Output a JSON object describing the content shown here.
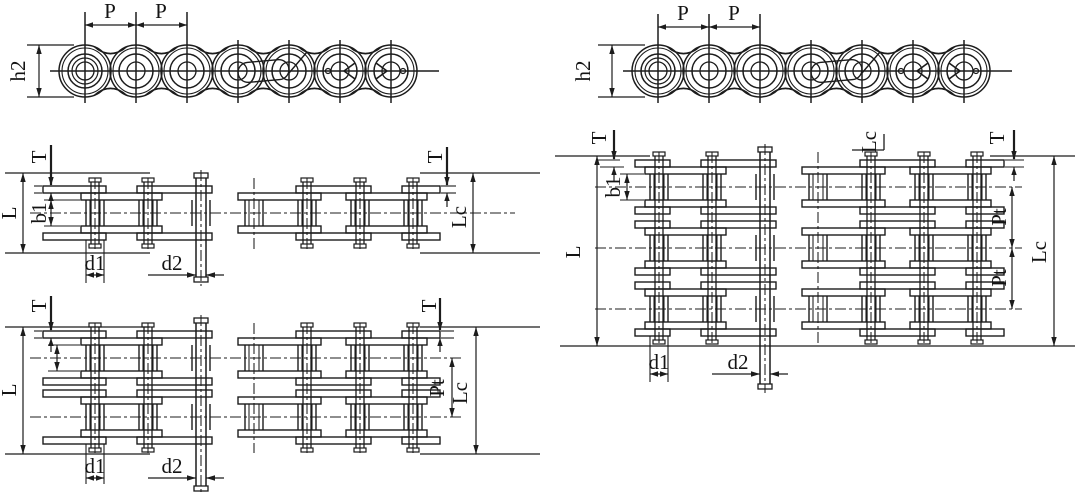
{
  "style": {
    "line_color": "#1c1c1c"
  },
  "labels": {
    "side_left": {
      "p_left": "P",
      "p_right": "P",
      "height": "h2"
    },
    "simplex": {
      "t_left": "T",
      "length_l": "L",
      "inner_width": "b1",
      "roller_dia": "d1",
      "pin_dia": "d2",
      "t_right": "T",
      "length_lc": "Lc"
    },
    "duplex": {
      "t_left": "T",
      "length_l": "L",
      "roller_dia": "d1",
      "pin_dia": "d2",
      "t_right": "T",
      "transverse_pitch": "Pt",
      "length_lc": "Lc"
    },
    "side_right": {
      "p_left": "P",
      "p_right": "P",
      "height": "h2"
    },
    "triplex": {
      "t_left": "T",
      "inner_width": "b1",
      "length_l": "L",
      "lc_top": "Lc",
      "t_right": "T",
      "transverse_pitch_upper": "Pt",
      "transverse_pitch_lower": "Pt",
      "length_lc": "Lc",
      "roller_dia": "d1",
      "pin_dia": "d2"
    }
  }
}
